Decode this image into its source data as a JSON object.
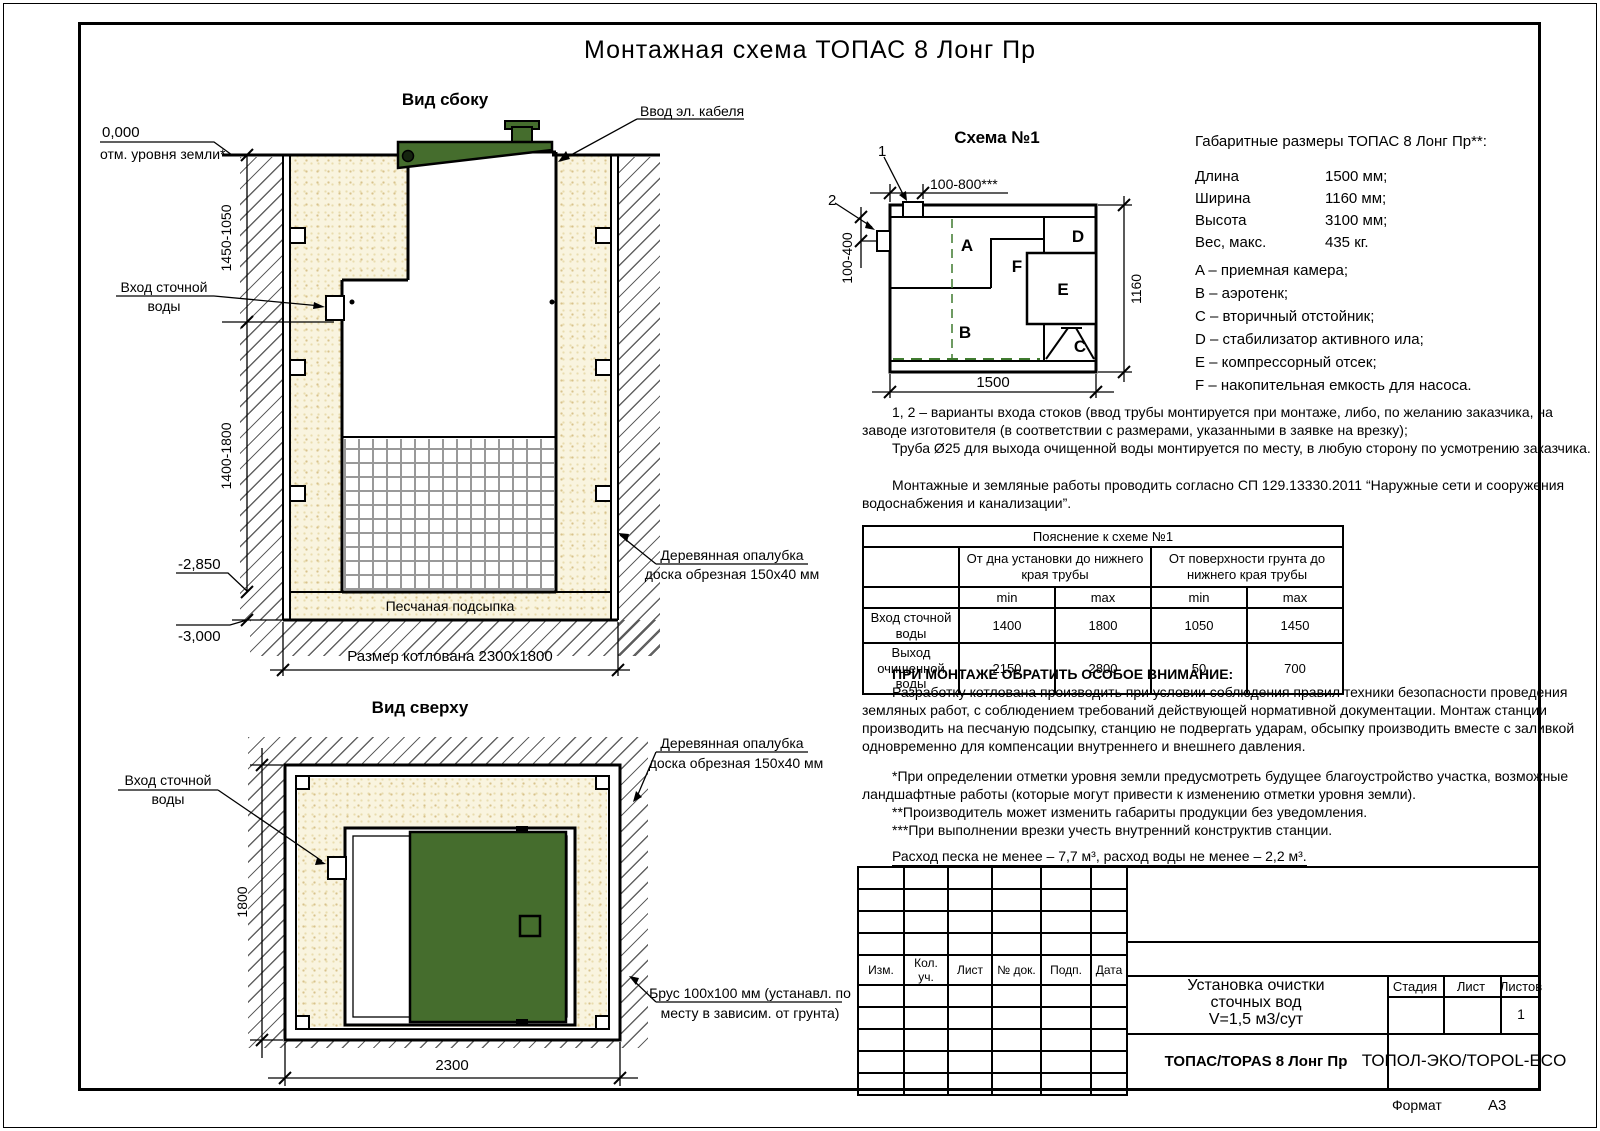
{
  "title": "Монтажная схема ТОПАС 8 Лонг Пр",
  "colors": {
    "green": "#456d2d",
    "dash_green": "#3f7a2f"
  },
  "side_view": {
    "label": "Вид сбоку",
    "zero_mark": "0,000",
    "zero_note": "отм. уровня земли*",
    "cable_callout": "Ввод эл. кабеля",
    "inlet_line1": "Вход сточной",
    "inlet_line2": "воды",
    "dim_upper": "1450-1050",
    "dim_lower": "1400-1800",
    "level_sand": "-2,850",
    "level_bottom": "-3,000",
    "bed_label": "Песчаная подсыпка",
    "pit_dim": "Размер котлована 2300x1800",
    "fw_line1": "Деревянная опалубка",
    "fw_line2": "доска обрезная 150x40 мм"
  },
  "schema1": {
    "label": "Схема №1",
    "marker1": "1",
    "marker2": "2",
    "dim_top": "100-800***",
    "dim_left": "100-400",
    "dim_right": "1160",
    "dim_bottom": "1500",
    "comp": {
      "a": "A",
      "b": "B",
      "c": "C",
      "d": "D",
      "e": "E",
      "f": "F"
    }
  },
  "sizes": {
    "title": "Габаритные размеры ТОПАС 8 Лонг Пр**:",
    "rows": [
      {
        "label": "Длина",
        "value": "1500 мм;"
      },
      {
        "label": "Ширина",
        "value": "1160 мм;"
      },
      {
        "label": "Высота",
        "value": "3100 мм;"
      },
      {
        "label": "Вес, макс.",
        "value": "435 кг."
      }
    ],
    "legend": [
      "A – приемная камера;",
      "B – аэротенк;",
      "C – вторичный отстойник;",
      "D – стабилизатор активного ила;",
      "E – компрессорный отсек;",
      "F – накопительная емкость для насоса."
    ]
  },
  "notes": {
    "lines": [
      "1, 2 – варианты входа  стоков (ввод трубы монтируется при монтаже, либо, по желанию заказчика, на",
      "заводе изготовителя (в соответствии с размерами, указанными в заявке на врезку);",
      "Труба Ø25 для выхода очищенной воды монтируется по месту, в любую сторону по усмотрению заказчика.",
      "Монтажные и земляные работы проводить согласно СП 129.13330.2011 “Наружные сети и сооружения",
      "водоснабжения и канализации”."
    ]
  },
  "table": {
    "title": "Пояснение к схеме №1",
    "group1": "От дна установки до нижнего края трубы",
    "group2": "От поверхности грунта до нижнего края трубы",
    "min": "min",
    "max": "max",
    "rows": [
      {
        "label": "Вход сточной воды",
        "v": [
          "1400",
          "1800",
          "1050",
          "1450"
        ]
      },
      {
        "label": "Выход очищенной воды",
        "v": [
          "2150",
          "2800",
          "50",
          "700"
        ]
      }
    ]
  },
  "attention": {
    "heading": "ПРИ МОНТАЖЕ ОБРАТИТЬ ОСОБОЕ ВНИМАНИЕ:",
    "lines": [
      "Разработку котлована производить при условии соблюдения правил техники безопасности проведения",
      "земляных работ, с соблюдением требований действующей нормативной документации. Монтаж станции",
      "производить на песчаную подсыпку, станцию не подвергать ударам, обсыпку производить вместе с заливкой",
      "одновременно для компенсации внутреннего и внешнего давления."
    ],
    "foot": [
      "*При определении отметки уровня земли предусмотреть будущее благоустройство участка, возможные",
      "ландшафтные работы (которые могут привести к изменению отметки уровня земли).",
      "**Производитель может изменить габариты продукции без уведомления.",
      "***При выполнении врезки учесть внутренний конструктив станции."
    ],
    "consumption": "Расход песка не менее – 7,7 м³, расход воды не менее – 2,2 м³."
  },
  "top_view": {
    "label": "Вид сверху",
    "inlet_line1": "Вход сточной",
    "inlet_line2": "воды",
    "fw_line1": "Деревянная опалубка",
    "fw_line2": "доска обрезная 150x40 мм",
    "beam_line1": "Брус 100x100 мм (устанавл. по",
    "beam_line2": "месту в зависим. от грунта)",
    "dim_h": "1800",
    "dim_w": "2300"
  },
  "titleblock": {
    "cols": [
      "Изм.",
      "Кол. уч.",
      "Лист",
      "№ док.",
      "Подп.",
      "Дата"
    ],
    "title_lines": [
      "Установка очистки",
      "сточных вод",
      "V=1,5 м3/сут"
    ],
    "stage": "Стадия",
    "sheet": "Лист",
    "sheets": "Листов",
    "sheets_value": "1",
    "product": "ТОПАС/TOPAS 8 Лонг Пр",
    "company": "ТОПОЛ-ЭКО/TOPOL-ECO",
    "format_label": "Формат",
    "format_value": "А3"
  }
}
